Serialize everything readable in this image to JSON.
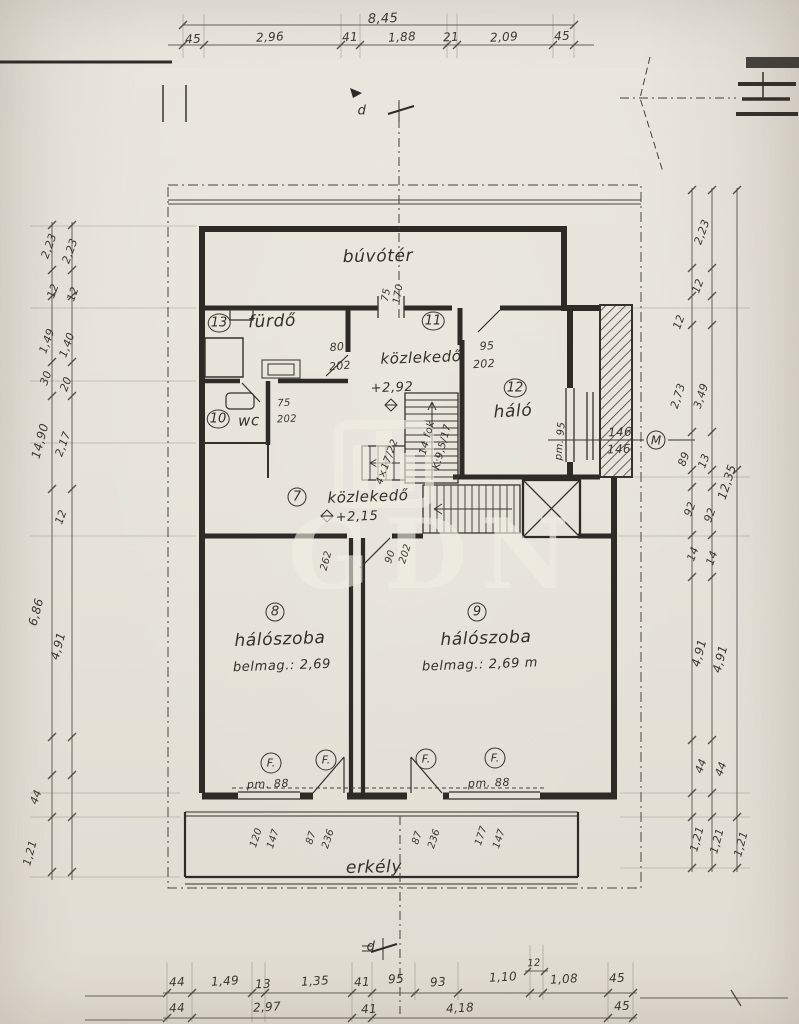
{
  "watermark": {
    "text": "GDN"
  },
  "labels": [
    [
      "dim-top-total",
      "8,45",
      383,
      19,
      -2,
      13,
      "dim"
    ],
    [
      "dim-top-1",
      "45",
      193,
      39,
      -3,
      12,
      "dim"
    ],
    [
      "dim-top-2",
      "2,96",
      270,
      37,
      -3,
      12,
      "dim"
    ],
    [
      "dim-top-3",
      "41",
      350,
      37,
      -3,
      12,
      "dim"
    ],
    [
      "dim-top-4",
      "1,88",
      402,
      37,
      -3,
      12,
      "dim"
    ],
    [
      "dim-top-5",
      "21",
      451,
      37,
      -3,
      12,
      "dim"
    ],
    [
      "dim-top-6",
      "2,09",
      504,
      37,
      -3,
      12,
      "dim"
    ],
    [
      "dim-top-7",
      "45",
      562,
      36,
      -3,
      12,
      "dim"
    ],
    [
      "section-mark-top-letter",
      "d",
      362,
      111,
      0,
      13,
      "hand"
    ],
    [
      "section-mark-bottom-letter",
      "d",
      371,
      947,
      0,
      13,
      "hand"
    ],
    [
      "dim-left-1",
      "2,23",
      49,
      246,
      -70,
      11,
      "dim"
    ],
    [
      "dim-left-2",
      "2,23",
      70,
      251,
      -70,
      11,
      "dim"
    ],
    [
      "dim-left-3",
      "12",
      53,
      291,
      -70,
      11,
      "dim"
    ],
    [
      "dim-left-4",
      "12",
      73,
      294,
      -70,
      11,
      "dim"
    ],
    [
      "dim-left-5",
      "1,49",
      47,
      341,
      -70,
      11,
      "dim"
    ],
    [
      "dim-left-6",
      "1,40",
      67,
      345,
      -70,
      11,
      "dim"
    ],
    [
      "dim-left-7",
      "30",
      46,
      378,
      -70,
      11,
      "dim"
    ],
    [
      "dim-left-8",
      "20",
      66,
      384,
      -70,
      11,
      "dim"
    ],
    [
      "dim-left-9",
      "14,90",
      40,
      441,
      -75,
      12,
      "dim"
    ],
    [
      "dim-left-10",
      "2,17",
      63,
      444,
      -70,
      11,
      "dim"
    ],
    [
      "dim-left-11",
      "12",
      61,
      517,
      -70,
      11,
      "dim"
    ],
    [
      "dim-left-12",
      "6,86",
      36,
      612,
      -75,
      12,
      "dim"
    ],
    [
      "dim-left-13",
      "4,91",
      58,
      646,
      -75,
      12,
      "dim"
    ],
    [
      "dim-left-14",
      "44",
      36,
      797,
      -70,
      11,
      "dim"
    ],
    [
      "dim-left-15",
      "1,21",
      30,
      853,
      -75,
      11,
      "dim"
    ],
    [
      "dim-right-1",
      "2,23",
      702,
      232,
      -70,
      11,
      "dim"
    ],
    [
      "dim-right-2",
      "12",
      698,
      286,
      -70,
      11,
      "dim"
    ],
    [
      "dim-right-3",
      "12",
      679,
      322,
      -70,
      11,
      "dim"
    ],
    [
      "dim-right-4",
      "2,73",
      678,
      396,
      -72,
      11,
      "dim"
    ],
    [
      "dim-right-5",
      "3,49",
      701,
      396,
      -72,
      11,
      "dim"
    ],
    [
      "dim-right-6",
      "89",
      684,
      459,
      -70,
      11,
      "dim"
    ],
    [
      "dim-right-7",
      "13",
      704,
      461,
      -70,
      11,
      "dim"
    ],
    [
      "dim-right-8",
      "12,35",
      727,
      482,
      -72,
      12,
      "dim"
    ],
    [
      "dim-right-9",
      "92",
      690,
      509,
      -70,
      11,
      "dim"
    ],
    [
      "dim-right-10",
      "92",
      710,
      515,
      -70,
      11,
      "dim"
    ],
    [
      "dim-right-11",
      "14",
      693,
      554,
      -70,
      11,
      "dim"
    ],
    [
      "dim-right-12",
      "14",
      712,
      558,
      -70,
      11,
      "dim"
    ],
    [
      "dim-right-13",
      "4,91",
      699,
      653,
      -75,
      12,
      "dim"
    ],
    [
      "dim-right-14",
      "4,91",
      720,
      659,
      -75,
      12,
      "dim"
    ],
    [
      "dim-right-15",
      "44",
      701,
      766,
      -70,
      11,
      "dim"
    ],
    [
      "dim-right-16",
      "44",
      721,
      769,
      -70,
      11,
      "dim"
    ],
    [
      "dim-right-17",
      "1,21",
      697,
      839,
      -75,
      11,
      "dim"
    ],
    [
      "dim-right-18",
      "1,21",
      717,
      841,
      -75,
      11,
      "dim"
    ],
    [
      "dim-right-19",
      "1,21",
      741,
      844,
      -75,
      11,
      "dim"
    ],
    [
      "room-buvoter-label",
      "búvótér",
      378,
      257,
      -1,
      17,
      "hand"
    ],
    [
      "room-13-number",
      "13",
      219,
      323,
      0,
      13,
      "circ"
    ],
    [
      "room-13-label",
      "fürdő",
      272,
      322,
      -2,
      17,
      "hand"
    ],
    [
      "shaft-dim-width",
      "75",
      387,
      295,
      -80,
      10,
      "dim"
    ],
    [
      "shaft-dim-height",
      "170",
      399,
      294,
      -80,
      10,
      "dim"
    ],
    [
      "room-11-number",
      "11",
      433,
      321,
      0,
      13,
      "circ"
    ],
    [
      "room-11-label",
      "közlekedő",
      421,
      358,
      -2,
      15,
      "hand"
    ],
    [
      "door-80-width",
      "80",
      337,
      347,
      -5,
      11,
      "dim"
    ],
    [
      "door-80-height",
      "202",
      340,
      366,
      -5,
      11,
      "dim"
    ],
    [
      "door-95-width",
      "95",
      487,
      346,
      -3,
      11,
      "dim"
    ],
    [
      "door-95-height",
      "202",
      484,
      364,
      -3,
      11,
      "dim"
    ],
    [
      "level-mark-292",
      "+2,92",
      392,
      388,
      -2,
      13,
      "hand"
    ],
    [
      "room-12-number",
      "12",
      515,
      388,
      0,
      13,
      "circ"
    ],
    [
      "room-12-label",
      "háló",
      513,
      412,
      -3,
      17,
      "hand"
    ],
    [
      "room-10-number",
      "10",
      218,
      419,
      0,
      13,
      "circ"
    ],
    [
      "room-10-label",
      "wc",
      249,
      421,
      -2,
      15,
      "hand"
    ],
    [
      "door-75-width",
      "75",
      284,
      404,
      -3,
      10,
      "dim"
    ],
    [
      "door-75-height",
      "202",
      287,
      420,
      -3,
      10,
      "dim"
    ],
    [
      "window-sill-95",
      "pm. 95",
      561,
      441,
      -85,
      10,
      "hand"
    ],
    [
      "window-146-width",
      "146",
      620,
      432,
      -2,
      12,
      "dim"
    ],
    [
      "window-146-height",
      "146.",
      621,
      449,
      -2,
      12,
      "dim"
    ],
    [
      "window-marker-M",
      "M",
      656,
      440,
      0,
      12,
      "circ"
    ],
    [
      "stair-upper-label",
      "14 fok",
      428,
      438,
      -75,
      10,
      "hand"
    ],
    [
      "stair-upper-note",
      "K:9,5/17",
      443,
      447,
      -75,
      10,
      "hand"
    ],
    [
      "stair-small-note",
      "4×17/22",
      388,
      462,
      -70,
      10,
      "hand"
    ],
    [
      "room-7-number",
      "7",
      297,
      497,
      0,
      13,
      "circ"
    ],
    [
      "room-7-label",
      "közlekedő",
      368,
      497,
      -2,
      15,
      "hand"
    ],
    [
      "level-mark-215",
      "+2,15",
      357,
      517,
      -2,
      13,
      "hand"
    ],
    [
      "dim-262",
      "262",
      327,
      561,
      -75,
      10,
      "dim"
    ],
    [
      "door-90-width",
      "90",
      391,
      557,
      -72,
      10,
      "dim"
    ],
    [
      "door-90-height",
      "202",
      406,
      554,
      -72,
      10,
      "dim"
    ],
    [
      "room-8-number",
      "8",
      275,
      612,
      0,
      13,
      "circ"
    ],
    [
      "room-8-label",
      "hálószoba",
      280,
      640,
      -2,
      17,
      "hand"
    ],
    [
      "room-8-note",
      "belmag.: 2,69",
      282,
      666,
      -2,
      13,
      "hand"
    ],
    [
      "room-9-number",
      "9",
      477,
      612,
      0,
      13,
      "circ"
    ],
    [
      "room-9-label",
      "hálószoba",
      486,
      639,
      -2,
      17,
      "hand"
    ],
    [
      "room-9-note",
      "belmag.: 2,69 m",
      480,
      665,
      -2,
      13,
      "hand"
    ],
    [
      "window-marker-F-1",
      "F.",
      271,
      763,
      0,
      11,
      "circS"
    ],
    [
      "window-marker-F-2",
      "F.",
      326,
      760,
      0,
      11,
      "circS"
    ],
    [
      "window-marker-F-3",
      "F.",
      426,
      759,
      0,
      11,
      "circS"
    ],
    [
      "window-marker-F-4",
      "F.",
      495,
      758,
      0,
      11,
      "circS"
    ],
    [
      "window-sill-88-left",
      "pm. 88",
      268,
      784,
      -2,
      11,
      "hand"
    ],
    [
      "window-sill-88-right",
      "pm. 88",
      489,
      783,
      -2,
      11,
      "hand"
    ],
    [
      "window-dim-120",
      "120",
      257,
      838,
      -72,
      10,
      "dim"
    ],
    [
      "window-dim-147a",
      "147",
      274,
      839,
      -72,
      10,
      "dim"
    ],
    [
      "door-dim-87a",
      "87",
      312,
      838,
      -72,
      10,
      "dim"
    ],
    [
      "door-dim-236a",
      "236",
      329,
      839,
      -72,
      10,
      "dim"
    ],
    [
      "door-dim-87b",
      "87",
      418,
      838,
      -72,
      10,
      "dim"
    ],
    [
      "door-dim-236b",
      "236",
      435,
      839,
      -72,
      10,
      "dim"
    ],
    [
      "window-dim-177",
      "177",
      482,
      836,
      -72,
      10,
      "dim"
    ],
    [
      "window-dim-147b",
      "147",
      500,
      839,
      -72,
      10,
      "dim"
    ],
    [
      "room-erkely-label",
      "erkély",
      374,
      868,
      -1,
      17,
      "hand"
    ],
    [
      "dim-bottom1-1",
      "44",
      177,
      982,
      -3,
      12,
      "dim"
    ],
    [
      "dim-bottom1-2",
      "1,49",
      225,
      981,
      -3,
      12,
      "dim"
    ],
    [
      "dim-bottom1-3",
      "13",
      263,
      984,
      -3,
      12,
      "dim"
    ],
    [
      "dim-bottom1-4",
      "1,35",
      315,
      981,
      -3,
      12,
      "dim"
    ],
    [
      "dim-bottom1-5",
      "41",
      362,
      982,
      -3,
      12,
      "dim"
    ],
    [
      "dim-bottom1-6",
      "95",
      396,
      979,
      -3,
      12,
      "dim"
    ],
    [
      "dim-bottom1-7",
      "93",
      438,
      982,
      -3,
      12,
      "dim"
    ],
    [
      "dim-bottom1-8",
      "1,10",
      503,
      977,
      -3,
      12,
      "dim"
    ],
    [
      "dim-bottom1-9",
      "12",
      534,
      964,
      -3,
      10,
      "dim"
    ],
    [
      "dim-bottom1-10",
      "1,08",
      564,
      979,
      -3,
      12,
      "dim"
    ],
    [
      "dim-bottom1-11",
      "45",
      617,
      978,
      -3,
      12,
      "dim"
    ],
    [
      "dim-bottom2-1",
      "44",
      177,
      1008,
      -3,
      12,
      "dim"
    ],
    [
      "dim-bottom2-2",
      "2,97",
      267,
      1007,
      -3,
      12,
      "dim"
    ],
    [
      "dim-bottom2-3",
      "41",
      369,
      1009,
      -3,
      12,
      "dim"
    ],
    [
      "dim-bottom2-4",
      "4,18",
      460,
      1008,
      -3,
      12,
      "dim"
    ],
    [
      "dim-bottom2-5",
      "45",
      622,
      1006,
      -3,
      12,
      "dim"
    ]
  ]
}
